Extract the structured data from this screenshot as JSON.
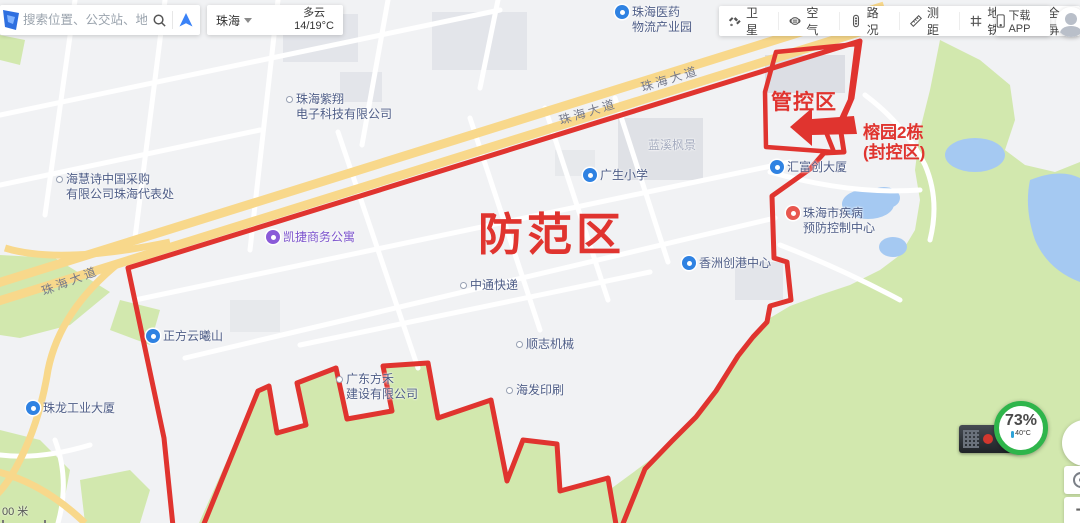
{
  "search": {
    "placeholder": "搜索位置、公交站、地铁站"
  },
  "weather": {
    "city": "珠海",
    "condition": "多云",
    "temperature": "14/19°C"
  },
  "toolbar": {
    "items": [
      {
        "label": "卫星",
        "icon": "satellite-icon"
      },
      {
        "label": "空气",
        "icon": "air-quality-icon"
      },
      {
        "label": "路况",
        "icon": "traffic-icon"
      },
      {
        "label": "测距",
        "icon": "measure-distance-icon"
      },
      {
        "label": "地铁",
        "icon": "metro-icon"
      },
      {
        "label": "全屏",
        "icon": "fullscreen-icon"
      }
    ],
    "download_label": "下载APP"
  },
  "zones": {
    "prevention": "防范区",
    "control": "管控区",
    "lockdown": "榕园2栋\n(封控区)"
  },
  "map": {
    "road_labels": [
      "珠海大道",
      "珠海大道",
      "珠海大道"
    ],
    "labels": [
      {
        "text": "珠海医药\n物流产业园",
        "type": "blue"
      },
      {
        "text": "珠海紫翔\n电子科技有限公司",
        "type": "dot"
      },
      {
        "text": "海慧诗中国采购\n有限公司珠海代表处",
        "type": "dot"
      },
      {
        "text": "广生小学",
        "type": "blue"
      },
      {
        "text": "凯捷商务公寓",
        "type": "purple"
      },
      {
        "text": "中通快递",
        "type": "dot"
      },
      {
        "text": "香洲创港中心",
        "type": "blue"
      },
      {
        "text": "顺志机械",
        "type": "dot"
      },
      {
        "text": "海发印刷",
        "type": "dot"
      },
      {
        "text": "广东方禾\n建设有限公司",
        "type": "dot"
      },
      {
        "text": "正方云曦山",
        "type": "blue"
      },
      {
        "text": "珠龙工业大厦",
        "type": "blue"
      },
      {
        "text": "汇富创大厦",
        "type": "blue"
      },
      {
        "text": "珠海市疾病\n预防控制中心",
        "type": "red"
      },
      {
        "text": "蓝溪枫景",
        "type": "plain"
      }
    ]
  },
  "overlay_widget": {
    "percent": "73%",
    "temperature": "40°C"
  },
  "controls": {
    "zoom_in": "+"
  },
  "scale": {
    "text": "00 米"
  },
  "colors": {
    "zone_red": "#e0342f",
    "highway": "#f8d88b",
    "park_green": "#d2e8ae",
    "water": "#a5c9f2"
  }
}
